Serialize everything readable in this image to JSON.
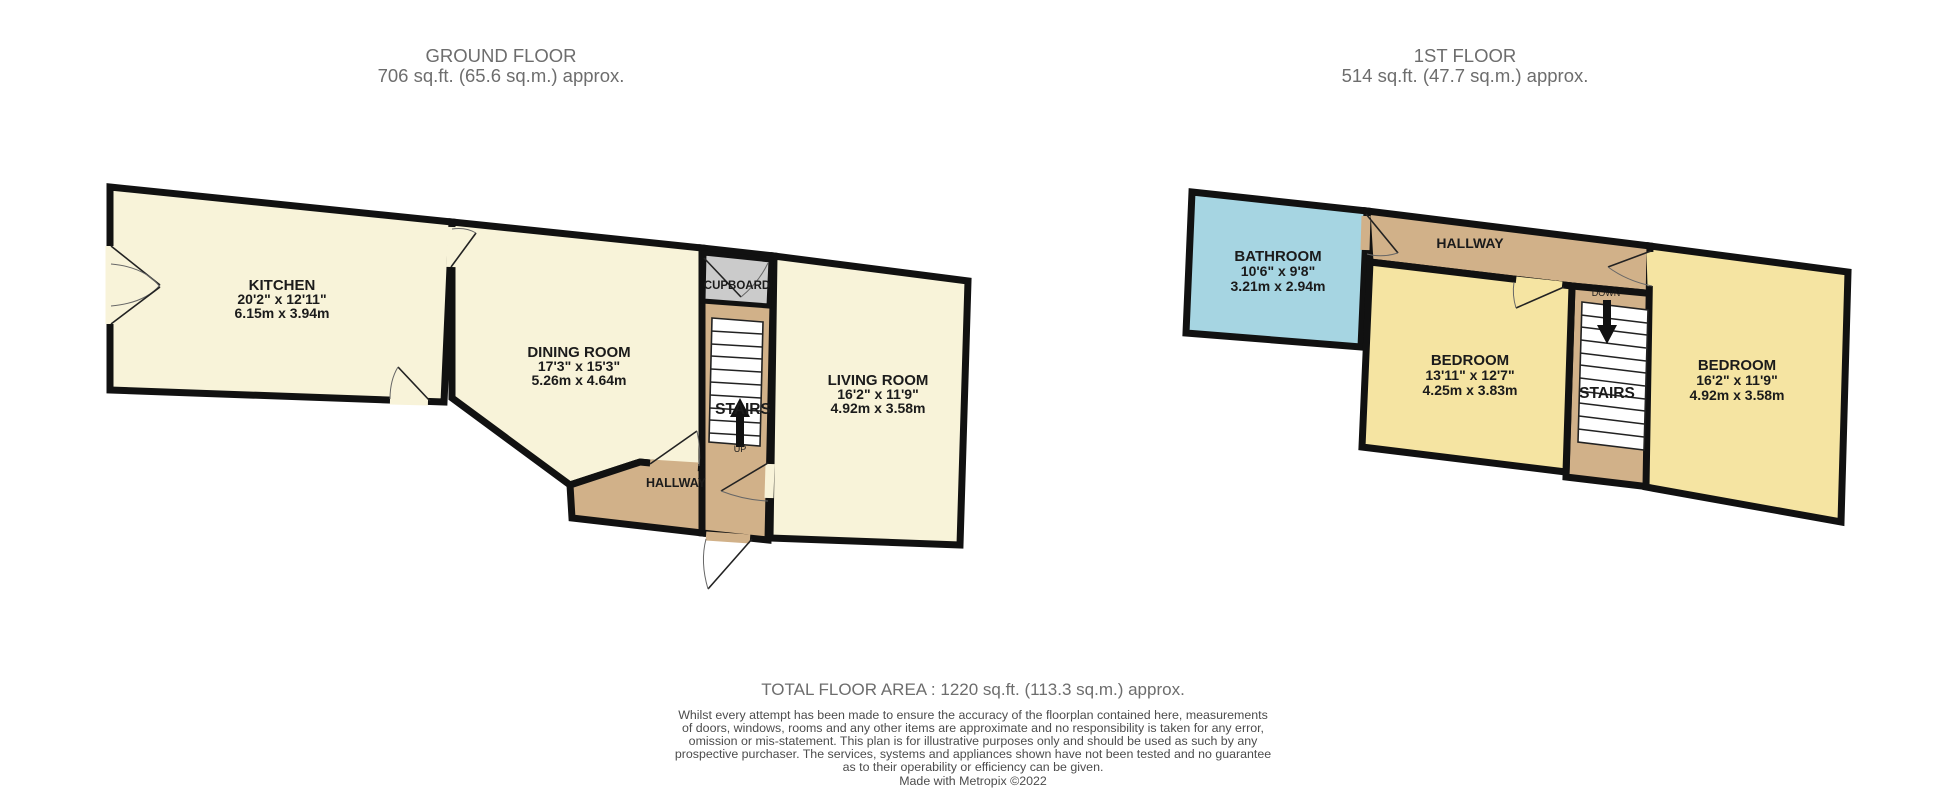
{
  "colors": {
    "background": "#ffffff",
    "room_cream": "#f8f3d9",
    "bedroom_yellow": "#f5e4a2",
    "hallway_tan": "#d1b189",
    "cupboard_grey": "#cbcbcb",
    "bathroom_blue": "#a6d5e2",
    "wall_black": "#111111",
    "title_grey": "#6d6d6d",
    "label_black": "#1b1b1b"
  },
  "ground_floor": {
    "title": "GROUND FLOOR",
    "subtitle": "706 sq.ft. (65.6 sq.m.) approx.",
    "kitchen": {
      "name": "KITCHEN",
      "dims_imperial": "20'2\"  x 12'11\"",
      "dims_metric": "6.15m  x 3.94m"
    },
    "dining_room": {
      "name": "DINING ROOM",
      "dims_imperial": "17'3\"  x 15'3\"",
      "dims_metric": "5.26m  x 4.64m"
    },
    "living_room": {
      "name": "LIVING ROOM",
      "dims_imperial": "16'2\"  x 11'9\"",
      "dims_metric": "4.92m  x 3.58m"
    },
    "cupboard": {
      "name": "CUPBOARD"
    },
    "stairs": {
      "name": "STAIRS",
      "direction": "UP"
    },
    "hallway": {
      "name": "HALLWAY"
    }
  },
  "first_floor": {
    "title": "1ST FLOOR",
    "subtitle": "514 sq.ft. (47.7 sq.m.) approx.",
    "bathroom": {
      "name": "BATHROOM",
      "dims_imperial": "10'6\"  x 9'8\"",
      "dims_metric": "3.21m  x 2.94m"
    },
    "hallway": {
      "name": "HALLWAY"
    },
    "bedroom_left": {
      "name": "BEDROOM",
      "dims_imperial": "13'11\"  x 12'7\"",
      "dims_metric": "4.25m  x 3.83m"
    },
    "bedroom_right": {
      "name": "BEDROOM",
      "dims_imperial": "16'2\"  x 11'9\"",
      "dims_metric": "4.92m  x 3.58m"
    },
    "stairs": {
      "name": "STAIRS",
      "direction": "DOWN"
    }
  },
  "footer": {
    "total": "TOTAL FLOOR AREA : 1220 sq.ft. (113.3 sq.m.) approx.",
    "disclaimer_lines": [
      "Whilst every attempt has been made to ensure the accuracy of the floorplan contained here, measurements",
      "of doors, windows, rooms and any other items are approximate and no responsibility is taken for any error,",
      "omission or mis-statement. This plan is for illustrative purposes only and should be used as such by any",
      "prospective purchaser. The services, systems and appliances shown have not been tested and no guarantee",
      "as to their operability or efficiency can be given."
    ],
    "credit": "Made with Metropix ©2022"
  }
}
